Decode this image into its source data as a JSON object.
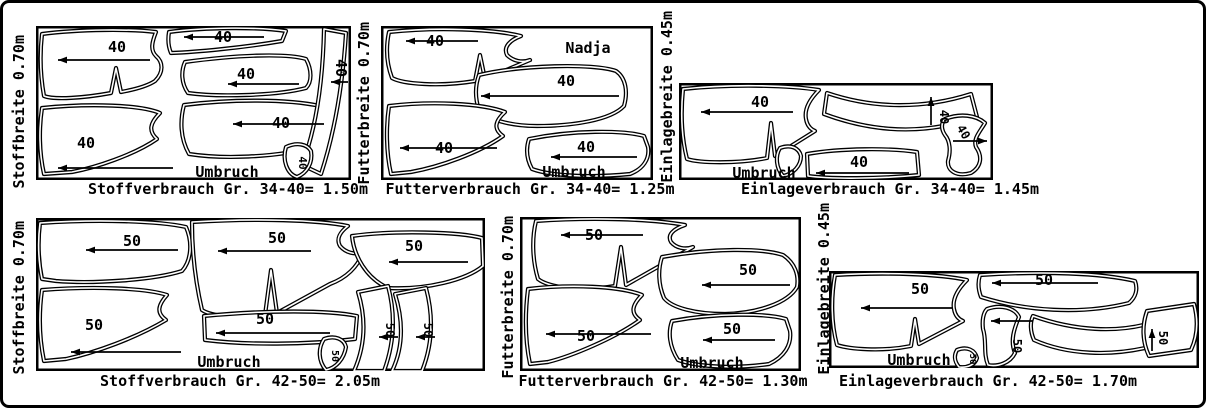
{
  "sheet": {
    "description_label": "Schnittmuster Zuschneideplaene"
  },
  "colors": {
    "ink": "#000000",
    "paper": "#ffffff"
  },
  "panels": [
    {
      "width_label": "Stoffbreite 0.70m",
      "caption": "Stoffverbrauch Gr. 34-40= 1.50m",
      "fold_label": "Umbruch",
      "size": "40"
    },
    {
      "width_label": "Futterbreite 0.70m",
      "caption": "Futterverbrauch Gr. 34-40= 1.25m",
      "fold_label": "Umbruch",
      "size": "40",
      "name_label": "Nadja"
    },
    {
      "width_label": "Einlagebreite 0.45m",
      "caption": "Einlageverbrauch Gr. 34-40= 1.45m",
      "fold_label": "Umbruch",
      "size": "40"
    },
    {
      "width_label": "Stoffbreite 0.70m",
      "caption": "Stoffverbrauch Gr. 42-50= 2.05m",
      "fold_label": "Umbruch",
      "size": "50"
    },
    {
      "width_label": "Futterbreite 0.70m",
      "caption": "Futterverbrauch Gr. 42-50= 1.30m",
      "fold_label": "Umbruch",
      "size": "50"
    },
    {
      "width_label": "Einlagebreite 0.45m",
      "caption": "Einlageverbrauch Gr. 42-50= 1.70m",
      "fold_label": "Umbruch",
      "size": "50"
    }
  ]
}
